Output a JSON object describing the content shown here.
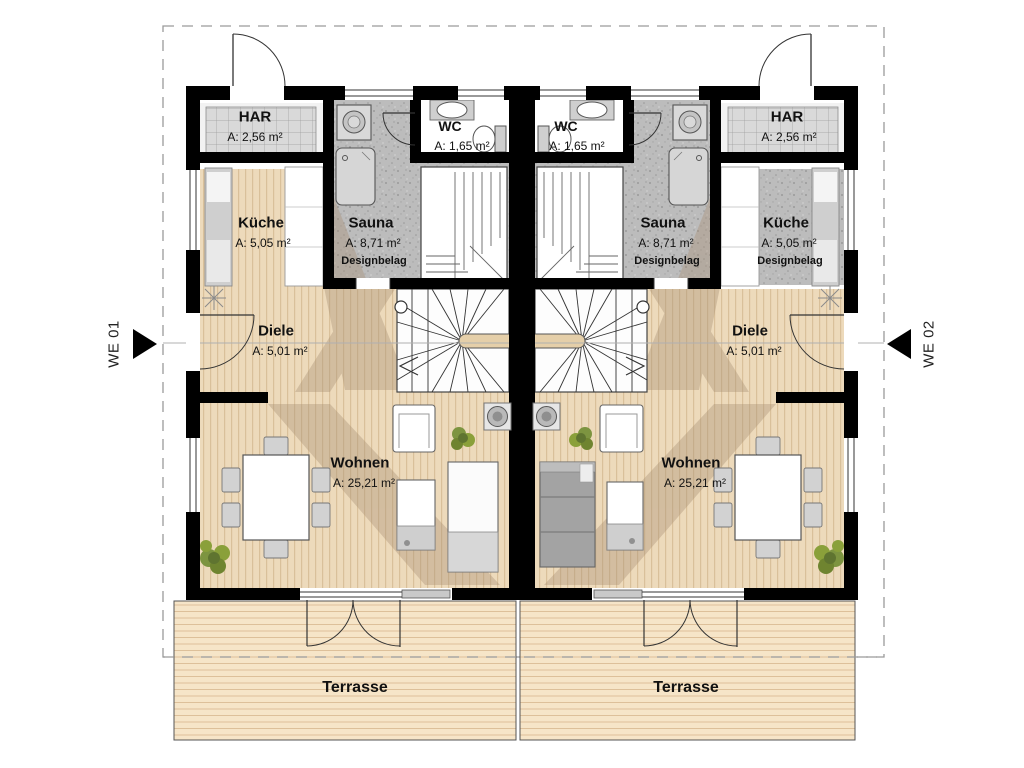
{
  "units": {
    "left": {
      "marker": "WE 01",
      "har": {
        "name": "HAR",
        "area": "A: 2,56 m²"
      },
      "wc": {
        "name": "WC",
        "area": "A: 1,65 m²"
      },
      "sauna": {
        "name": "Sauna",
        "area": "A: 8,71 m²",
        "note": "Designbelag"
      },
      "kueche": {
        "name": "Küche",
        "area": "A: 5,05 m²"
      },
      "diele": {
        "name": "Diele",
        "area": "A: 5,01 m²"
      },
      "wohnen": {
        "name": "Wohnen",
        "area": "A: 25,21 m²"
      },
      "terrasse": {
        "name": "Terrasse"
      }
    },
    "right": {
      "marker": "WE 02",
      "wc": {
        "name": "WC",
        "area": "A: 1,65 m²"
      },
      "sauna": {
        "name": "Sauna",
        "area": "A: 8,71 m²",
        "note": "Designbelag"
      },
      "har": {
        "name": "HAR",
        "area": "A: 2,56 m²"
      },
      "kueche": {
        "name": "Küche",
        "area": "A: 5,05 m²",
        "note": "Designbelag"
      },
      "diele": {
        "name": "Diele",
        "area": "A: 5,01 m²"
      },
      "wohnen": {
        "name": "Wohnen",
        "area": "A: 25,21 m²"
      },
      "terrasse": {
        "name": "Terrasse"
      }
    }
  },
  "colors": {
    "wall": "#000000",
    "wood_floor": "#eddabb",
    "design_floor": "#bcbcbc",
    "terrace": "#f6e5c8",
    "plant_green": "#7d9440",
    "shadow": "#a78f74"
  }
}
